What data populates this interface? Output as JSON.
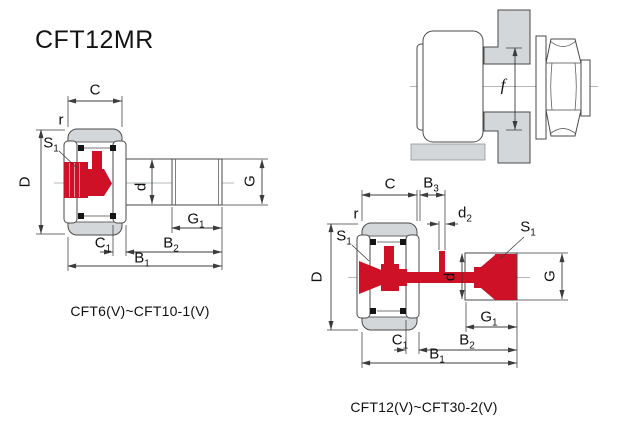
{
  "title": "CFT12MR",
  "colors": {
    "red": "#CE1126",
    "gray": "#D4D7D9",
    "outline": "#4A4A4A",
    "dimension_line": "#3C3C3C",
    "text": "#111111"
  },
  "figures": {
    "left": {
      "caption": "CFT6(V)~CFT10-1(V)",
      "labels": {
        "C": {
          "main": "C",
          "sub": ""
        },
        "r": {
          "main": "r",
          "sub": ""
        },
        "S1": {
          "main": "S",
          "sub": "1"
        },
        "D": {
          "main": "D",
          "sub": ""
        },
        "d": {
          "main": "d",
          "sub": ""
        },
        "G": {
          "main": "G",
          "sub": ""
        },
        "G1": {
          "main": "G",
          "sub": "1"
        },
        "C1": {
          "main": "C",
          "sub": "1"
        },
        "B2": {
          "main": "B",
          "sub": "2"
        },
        "B1": {
          "main": "B",
          "sub": "1"
        }
      }
    },
    "right": {
      "caption": "CFT12(V)~CFT30-2(V)",
      "labels": {
        "C": {
          "main": "C",
          "sub": ""
        },
        "B3": {
          "main": "B",
          "sub": "3"
        },
        "d2": {
          "main": "d",
          "sub": "2"
        },
        "r": {
          "main": "r",
          "sub": ""
        },
        "S1_left": {
          "main": "S",
          "sub": "1"
        },
        "S1_right": {
          "main": "S",
          "sub": "1"
        },
        "D": {
          "main": "D",
          "sub": ""
        },
        "d": {
          "main": "d",
          "sub": ""
        },
        "G": {
          "main": "G",
          "sub": ""
        },
        "G1": {
          "main": "G",
          "sub": "1"
        },
        "C1": {
          "main": "C",
          "sub": "1"
        },
        "B2": {
          "main": "B",
          "sub": "2"
        },
        "B1": {
          "main": "B",
          "sub": "1"
        }
      }
    },
    "mount": {
      "labels": {
        "f": {
          "main": "f",
          "sub": ""
        }
      }
    }
  }
}
